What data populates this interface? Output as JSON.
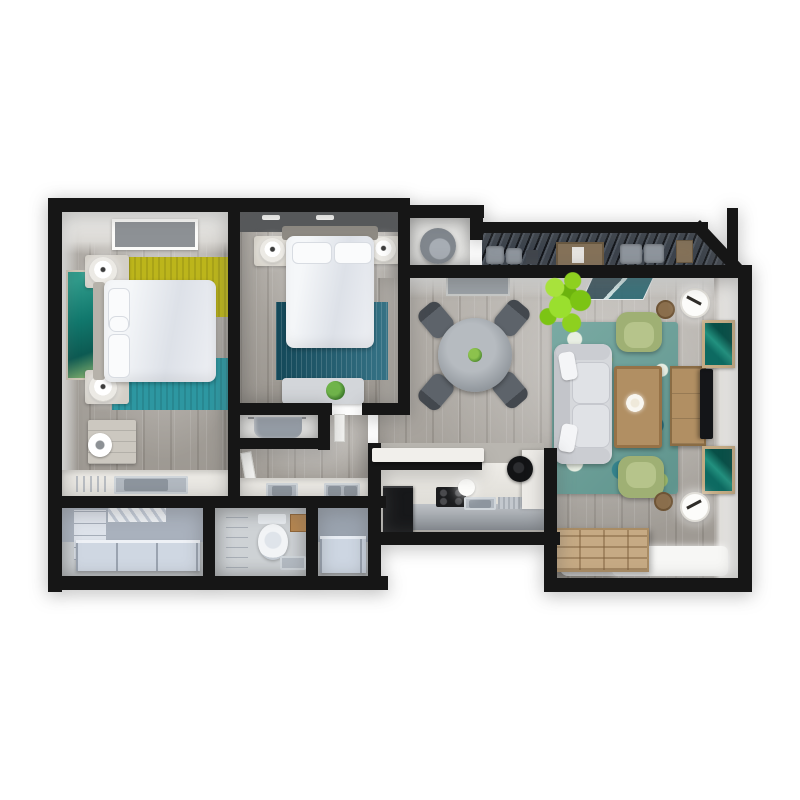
{
  "scene": {
    "kind": "3d-floor-plan-top-down-render",
    "subject": "two-bedroom apartment with balcony",
    "background": "#ffffff",
    "visible_text": []
  },
  "colors": {
    "wall": "#161616",
    "wood-floor": "#a7a29b",
    "light-floor": "#ced2d5",
    "wall-face": "#ebebe9",
    "rug-yellow": "#bcb51b",
    "rug-teal": "#2d97a1",
    "rug-blue": "#1a6076",
    "sofa-gray": "#d6d8dc",
    "armchair": "#9fb074",
    "wood-furniture": "#b18f63",
    "tv-black": "#141518",
    "deck": "#3b424b",
    "plant-green": "#8ed01f",
    "fixture-blue": "#cdd6e2",
    "counter-white": "#eae8e3",
    "appliance-black": "#17181a",
    "art-teal": "#0d6a61",
    "bedding-white": "#f5f7f9"
  },
  "rooms": [
    {
      "id": "bedroom-1",
      "furniture": [
        "double-bed",
        "headboard",
        "pillows",
        "nightstand-left-top",
        "nightstand-left-bottom",
        "table-lamp",
        "table-lamp",
        "wall-art",
        "yellow-rug",
        "teal-rug",
        "dresser",
        "fan",
        "skylight",
        "vanity-counter",
        "sink"
      ]
    },
    {
      "id": "bedroom-2",
      "furniture": [
        "double-bed",
        "headboard",
        "pillows",
        "nightstand",
        "nightstand",
        "table-lamp",
        "table-lamp",
        "blue-rug",
        "foot-bench",
        "potted-plant",
        "ceiling-lights"
      ]
    },
    {
      "id": "closet-bedroom-2",
      "furniture": [
        "hanging-clothes",
        "shelf"
      ]
    },
    {
      "id": "hallway-bath",
      "furniture": [
        "door",
        "vanity-counter",
        "sink",
        "double-sink"
      ]
    },
    {
      "id": "walk-in-closet",
      "furniture": [
        "cabinet-column",
        "hanging-rod",
        "storage-bench"
      ]
    },
    {
      "id": "toilet-room",
      "furniture": [
        "shelf-partition",
        "toilet",
        "wood-stool",
        "small-sink"
      ]
    },
    {
      "id": "shower-room",
      "furniture": [
        "bathtub"
      ]
    },
    {
      "id": "kitchen",
      "furniture": [
        "bar-counter",
        "refrigerator",
        "cooktop",
        "kitchen-sink",
        "dish-rack",
        "range-hood",
        "pendant-light",
        "base-cabinets",
        "counter-column"
      ]
    },
    {
      "id": "dining-area",
      "furniture": [
        "round-table",
        "dining-chair",
        "dining-chair",
        "dining-chair",
        "dining-chair",
        "centerpiece-plant",
        "ceiling-vent"
      ]
    },
    {
      "id": "living-room",
      "furniture": [
        "sofa",
        "floral-rug",
        "armchair",
        "armchair",
        "coffee-table",
        "flower-decor",
        "media-console",
        "tv",
        "wall-frame",
        "wall-frame",
        "floor-lamp",
        "floor-lamp",
        "side-table",
        "side-table",
        "pallet-daybed",
        "floor-mat",
        "large-plant",
        "glass-door"
      ]
    },
    {
      "id": "balcony",
      "furniture": [
        "slatted-pergola-deck",
        "outdoor-cushions",
        "outdoor-cabinet",
        "outdoor-stool"
      ]
    },
    {
      "id": "entry-nook",
      "furniture": [
        "round-chair"
      ]
    }
  ]
}
